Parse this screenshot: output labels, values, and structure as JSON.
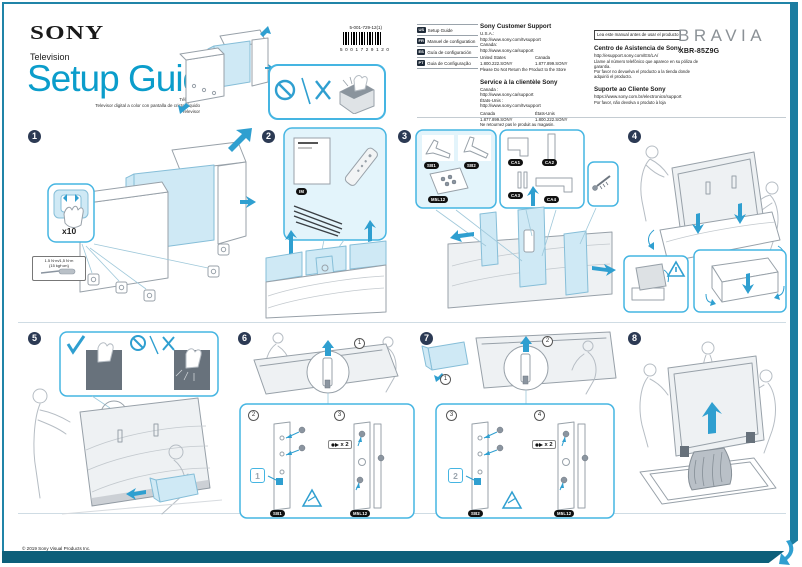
{
  "header": {
    "brand": "SONY",
    "product_type": "Television",
    "title": "Setup Guide",
    "subtitle_line1": "Téléviseur",
    "subtitle_line2": "Televisor digital a color con pantalla de cristal líquido",
    "subtitle_line3": "Televisor",
    "part_number": "5-001-729-12(1)",
    "barcode_digits": "5001729120",
    "bravia_logo": "BRAVIA",
    "model": "XBR-85Z9G"
  },
  "languages": [
    {
      "code": "US",
      "label": "Setup Guide"
    },
    {
      "code": "FR",
      "label": "Manuel de configuration"
    },
    {
      "code": "ES",
      "label": "Guía de configuración"
    },
    {
      "code": "PT",
      "label": "Guia de Configuração"
    }
  ],
  "support_en": {
    "heading": "Sony Customer Support",
    "region1": "U.S.A.:",
    "url1": "http://www.sony.com/tvsupport",
    "region2": "Canada:",
    "url2": "http://www.sony.ca/support",
    "phone_region1": "United States",
    "phone_region2": "Canada",
    "phone1": "1.800.222.SONY",
    "phone2": "1.877.899.SONY",
    "note": "Please Do Not Return the Product to the Store"
  },
  "support_fr": {
    "heading": "Service à la clientèle Sony",
    "region1": "Canada :",
    "url1": "http://www.sony.ca/support",
    "region2": "États-Unis :",
    "url2": "http://www.sony.com/tvsupport",
    "phone_region1": "Canada",
    "phone_region2": "États-Unis",
    "phone1": "1.877.899.SONY",
    "phone2": "1.800.222.SONY",
    "note": "Ne retournez pas le produit au magasin."
  },
  "support_es": {
    "read_first": "Lea este manual antes de usar el producto",
    "heading": "Centro de Asistencia de Sony",
    "url": "http://esupport.sony.com/ES/LA/",
    "line1": "Llame al número telefónico que aparece en su póliza de garantía.",
    "line2": "Por favor no devuelva el producto a la tienda donde adquirió el producto."
  },
  "support_pt": {
    "heading": "Suporte ao Cliente Sony",
    "url": "https://www.sony.com.br/electronics/support",
    "line1": "Por favor, não devolva o produto à loja"
  },
  "steps": {
    "s1": {
      "num": "1",
      "x10": "x10",
      "torque1": "1.5 N·m/1,5 N·m",
      "torque2": "{15 kgf·cm}"
    },
    "s2": {
      "num": "2",
      "manual_badge": "IM"
    },
    "s3": {
      "num": "3",
      "badge_leg1": "SB1",
      "badge_leg2": "SB2",
      "badge_bag": "M5L12",
      "badge_cover1": "CA1",
      "badge_cover2": "CA2",
      "badge_cover3": "CA3",
      "badge_cover4": "CA4"
    },
    "s4": {
      "num": "4"
    },
    "s5": {
      "num": "5"
    },
    "s6": {
      "num": "6",
      "sub1": "1",
      "sub2": "2",
      "sub3": "3",
      "slot": "1",
      "qty": "x 2",
      "badge_leg": "SB1",
      "badge_bag": "M5L12"
    },
    "s7": {
      "num": "7",
      "sub1": "1",
      "sub2": "2",
      "sub3": "3",
      "sub4": "4",
      "slot": "2",
      "qty": "x 2",
      "badge_leg": "SB2",
      "badge_bag": "M5L12"
    },
    "s8": {
      "num": "8"
    }
  },
  "footer": {
    "copyright": "© 2019 Sony Visual Products Inc."
  },
  "colors": {
    "accent": "#0b9dcb",
    "callout_border": "#45b5e2",
    "arrow": "#2f9fd0",
    "frame_teal": "#1b7ca0",
    "bottom_bar": "#0d5f7a"
  }
}
